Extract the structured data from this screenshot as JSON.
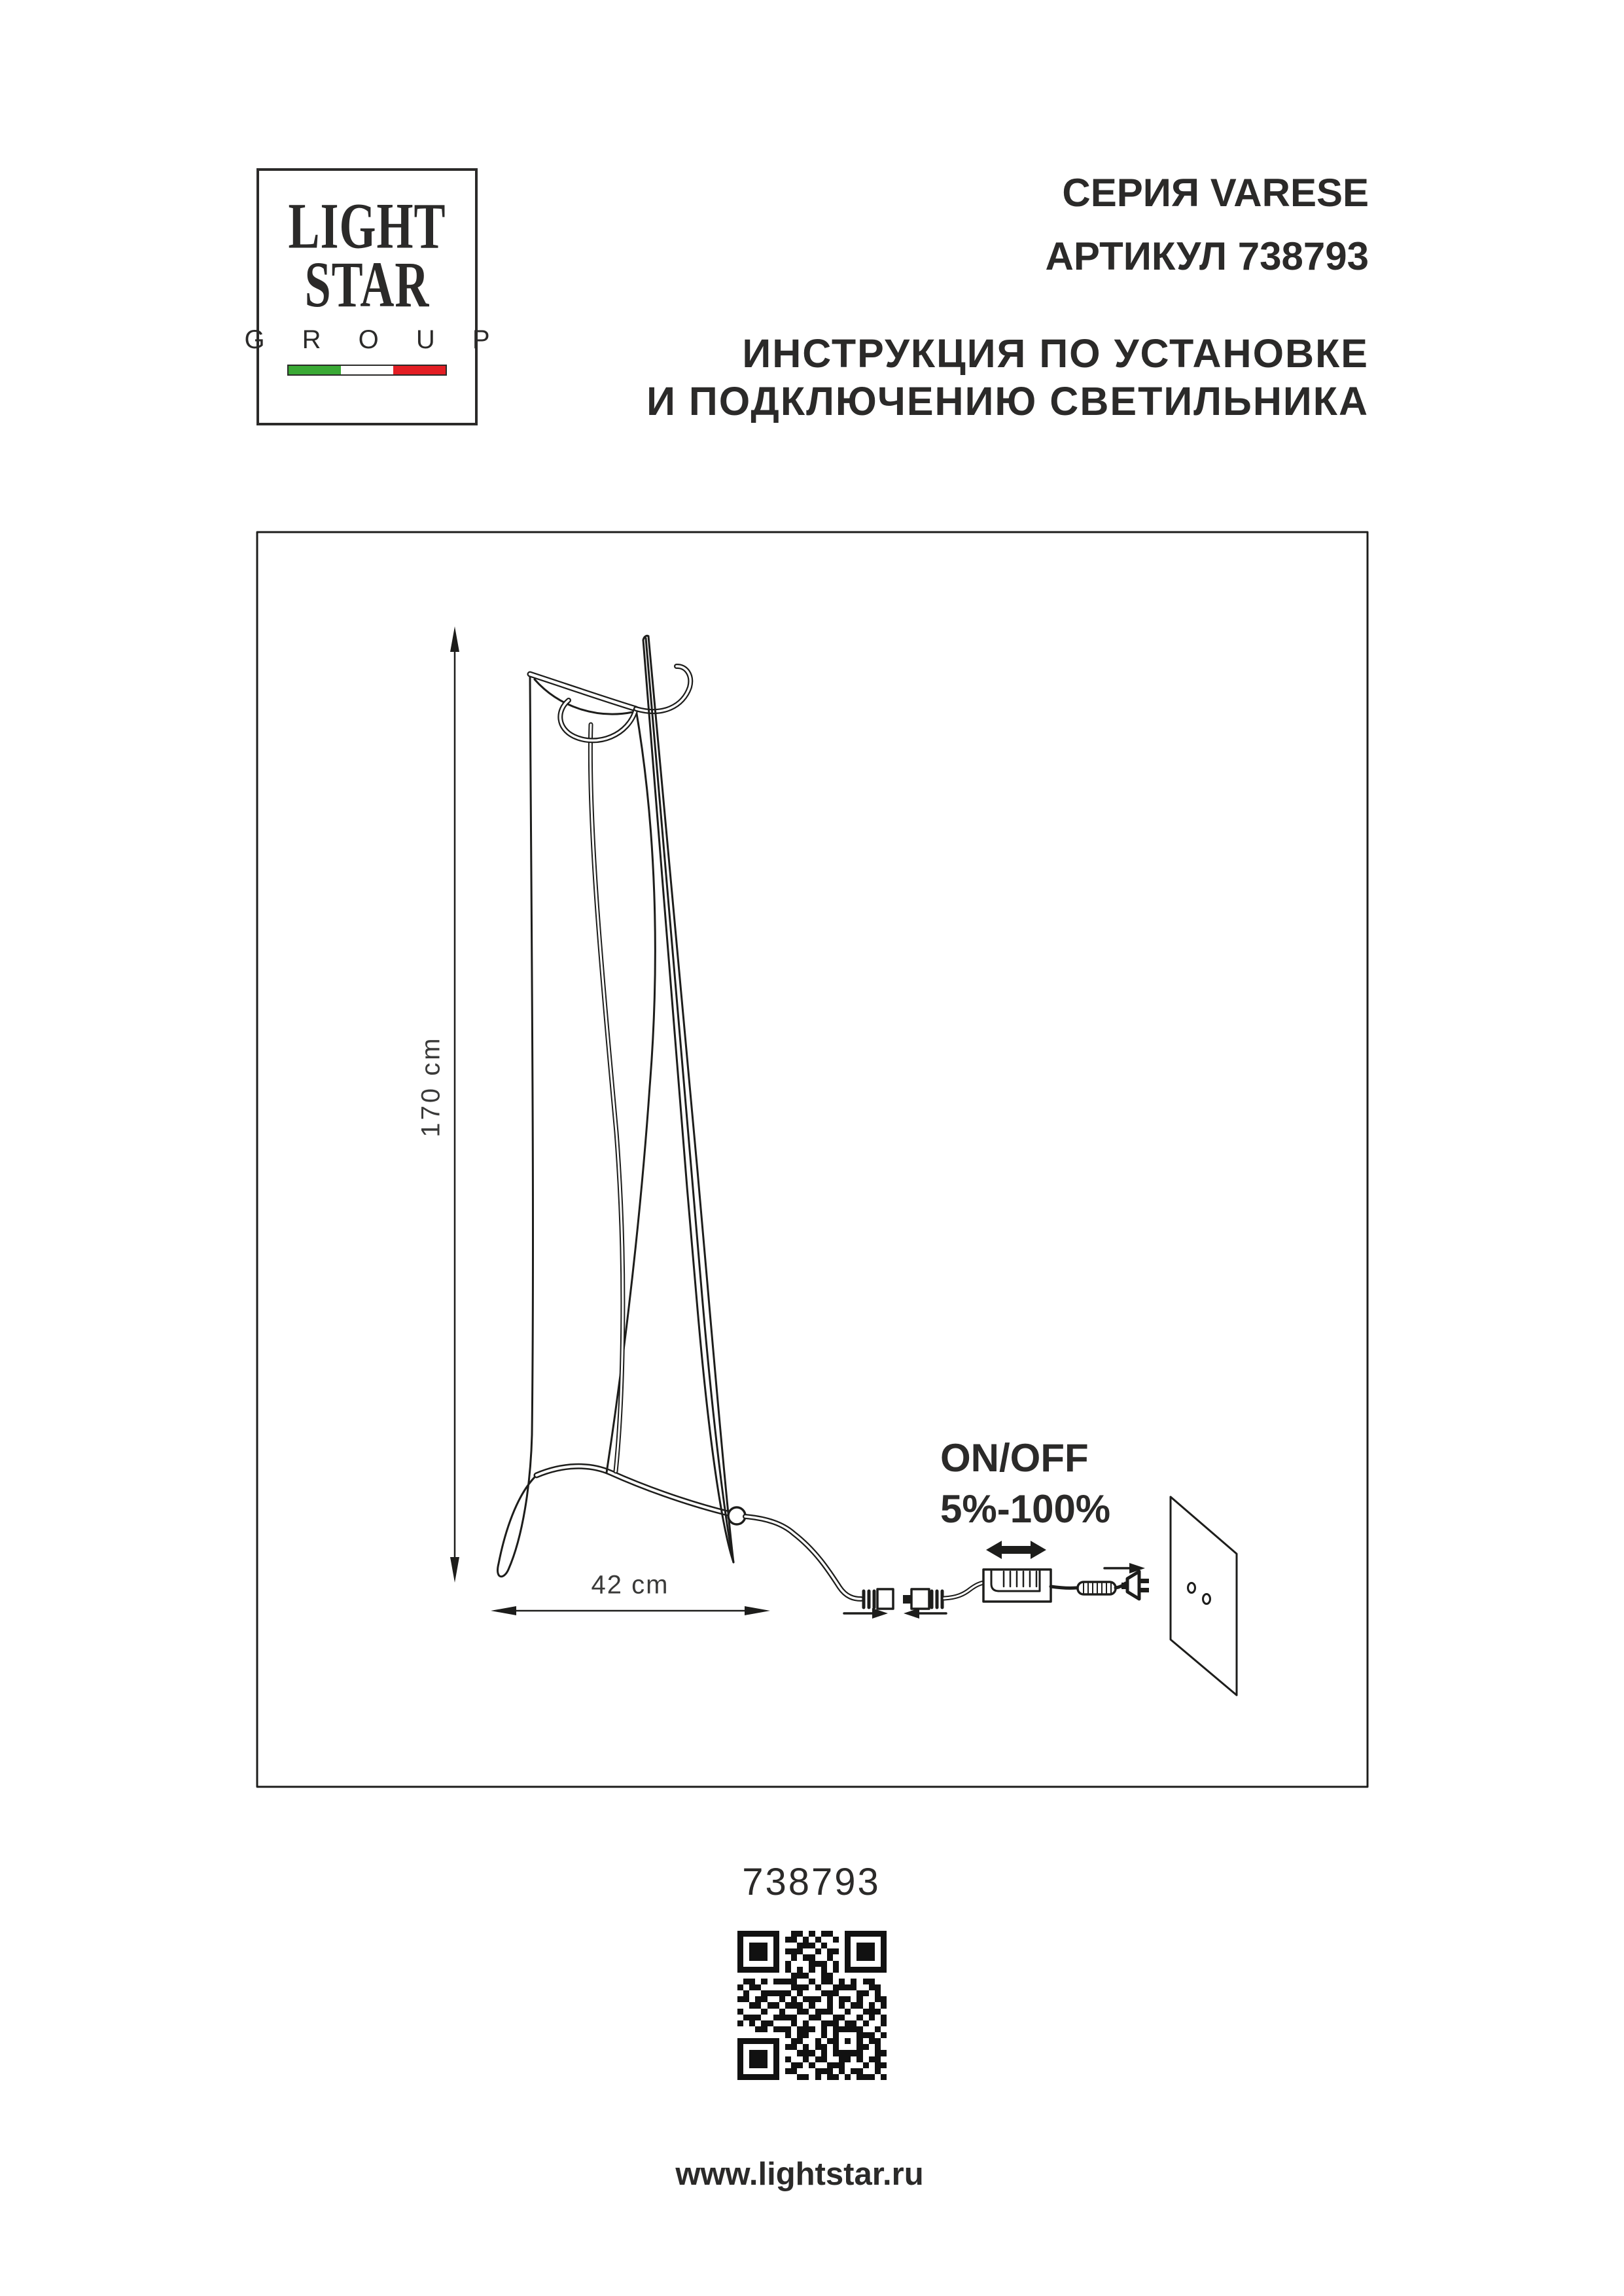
{
  "page": {
    "background": "#ffffff",
    "ink": "#2b2a29",
    "line_color": "#1d1d1b"
  },
  "logo": {
    "word1": "LIGHT",
    "word2": "STAR",
    "word3": "G R O U P",
    "flag": {
      "green": "#3aa935",
      "white": "#ffffff",
      "red": "#e31e24"
    }
  },
  "header": {
    "series": "СЕРИЯ VARESE",
    "article": "АРТИКУЛ 738793",
    "instruction_line1": "ИНСТРУКЦИЯ ПО УСТАНОВКЕ",
    "instruction_line2": "И ПОДКЛЮЧЕНИЮ СВЕТИЛЬНИКА"
  },
  "diagram": {
    "height_label": "170 cm",
    "width_label": "42 cm",
    "dimmer_label_line1": "ON/OFF",
    "dimmer_label_line2": "5%-100%"
  },
  "footer": {
    "article_number": "738793",
    "website": "www.lightstar.ru"
  },
  "qr": {
    "size": 25,
    "rows": [
      "1111111001101011001111111",
      "1000001011010100101000001",
      "1011101000111010001011101",
      "1011101011100101101011101",
      "1011101001011001001011101",
      "1000001010001110101000001",
      "1111111010101010101111111",
      "0000000001110011000000000",
      "0110101111001011010101100",
      "1011000001110100111100110",
      "0100111110100011100011010",
      "1101100101011101011010011",
      "0011011011101001010110101",
      "1000100100110111001001110",
      "0111001111001100110010101",
      "1010110001010011101101001",
      "0001101110111010111110010",
      "0000000010110010100011101",
      "1111111001100101101010110",
      "1000001011010110100011010",
      "1011101000111010111110011",
      "1011101010010110011010110",
      "1011101001101001110001011",
      "1000001011000111010110010",
      "1111111000110101101011101"
    ]
  }
}
